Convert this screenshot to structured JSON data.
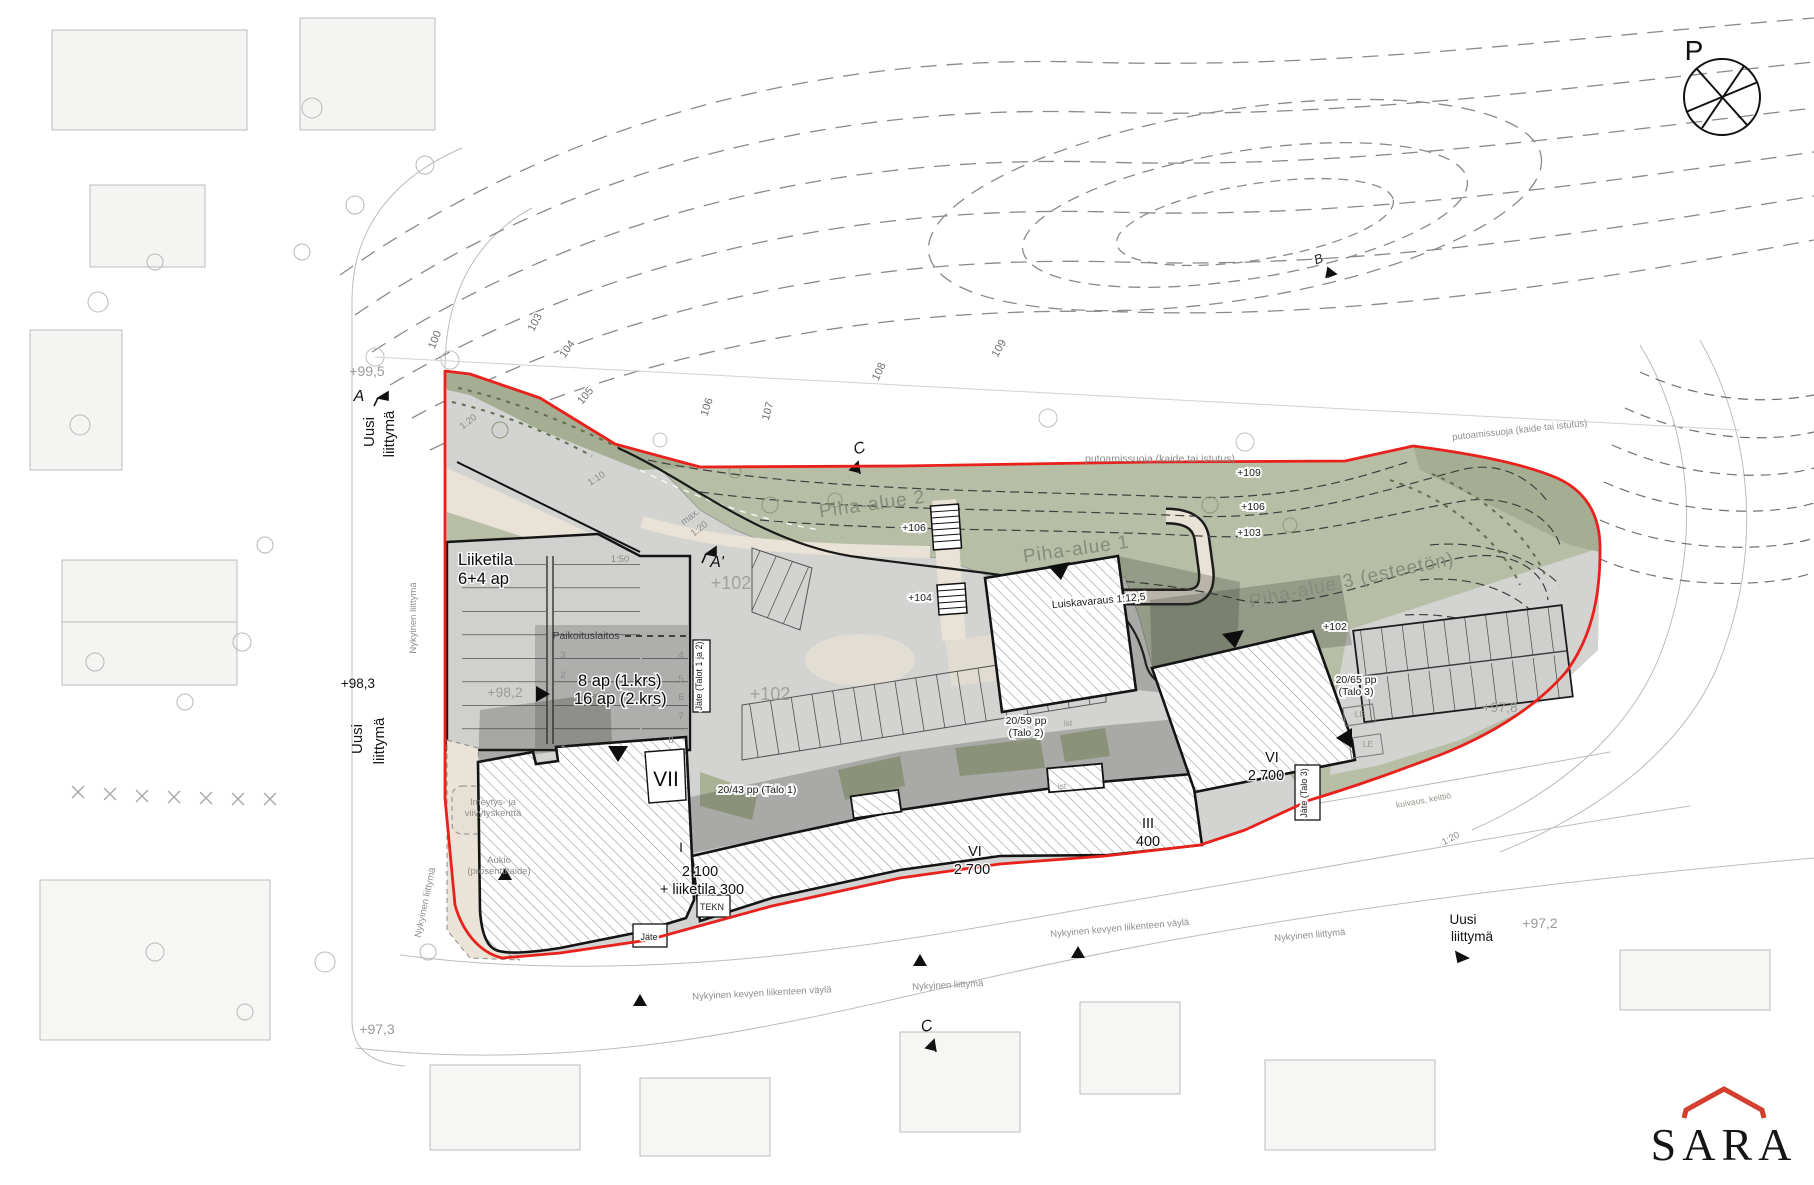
{
  "compass": {
    "letter": "P"
  },
  "logo": {
    "text": "SARA"
  },
  "colors": {
    "site_boundary_red": "#e8211c",
    "green_yard": "#b6bea6",
    "green_slope_dark": "#a5ae93",
    "paving_gray": "#d3d3d1",
    "deck_shadow": "rgba(40,42,38,0.20)",
    "building_fill": "#ffffff",
    "building_outline": "#141414",
    "path_beige": "#e9e2d6",
    "logo_red": "#d4402f"
  },
  "labels": [
    {
      "id": "contour-label-100",
      "text": "100",
      "x": 438,
      "y": 341,
      "rot": -68,
      "cls": "contour"
    },
    {
      "id": "contour-label-103",
      "text": "103",
      "x": 538,
      "y": 324,
      "rot": -62,
      "cls": "contour"
    },
    {
      "id": "contour-label-104",
      "text": "104",
      "x": 570,
      "y": 351,
      "rot": -55,
      "cls": "contour"
    },
    {
      "id": "contour-label-105",
      "text": "105",
      "x": 588,
      "y": 398,
      "rot": -50,
      "cls": "contour"
    },
    {
      "id": "contour-label-106",
      "text": "106",
      "x": 710,
      "y": 408,
      "rot": -72,
      "cls": "contour"
    },
    {
      "id": "contour-label-107",
      "text": "107",
      "x": 771,
      "y": 412,
      "rot": -75,
      "cls": "contour"
    },
    {
      "id": "contour-label-108",
      "text": "108",
      "x": 882,
      "y": 373,
      "rot": -65,
      "cls": "contour"
    },
    {
      "id": "contour-label-109",
      "text": "109",
      "x": 1002,
      "y": 350,
      "rot": -60,
      "cls": "contour"
    },
    {
      "id": "elevation-99-5",
      "text": "+99,5",
      "x": 367,
      "y": 376,
      "cls": "gray-med"
    },
    {
      "id": "section-marker-a",
      "text": "A",
      "x": 359,
      "y": 401,
      "cls": "section"
    },
    {
      "id": "new-junction-1-line1",
      "text": "Uusi",
      "x": 374,
      "y": 432,
      "rot": -90,
      "cls": "v15"
    },
    {
      "id": "new-junction-1-line2",
      "text": "liittymä",
      "x": 394,
      "y": 434,
      "rot": -90,
      "cls": "v15"
    },
    {
      "id": "slope-1-20-top",
      "text": "1:20",
      "x": 470,
      "y": 424,
      "rot": -38,
      "cls": "gray-small"
    },
    {
      "id": "slope-1-10",
      "text": "1:10",
      "x": 598,
      "y": 481,
      "rot": -33,
      "cls": "gray-small"
    },
    {
      "id": "liiketila-line1",
      "text": "Liiketila",
      "x": 458,
      "y": 565,
      "cls": "black-16"
    },
    {
      "id": "liiketila-line2",
      "text": "6+4 ap",
      "x": 458,
      "y": 584,
      "cls": "black-16"
    },
    {
      "id": "slope-1-50",
      "text": "1:50",
      "x": 620,
      "y": 562,
      "cls": "gray-small"
    },
    {
      "id": "slope-max-line1",
      "text": "max.",
      "x": 692,
      "y": 519,
      "rot": -38,
      "cls": "gray-small"
    },
    {
      "id": "slope-max-line2",
      "text": "1:20",
      "x": 701,
      "y": 531,
      "rot": -38,
      "cls": "gray-small"
    },
    {
      "id": "section-marker-a2",
      "text": "A'",
      "x": 717,
      "y": 567,
      "cls": "section"
    },
    {
      "id": "elevation-102-a",
      "text": "+102",
      "x": 731,
      "y": 589,
      "cls": "gray-big"
    },
    {
      "id": "paikoituslaitos",
      "text": "Paikoituslaitos",
      "x": 586,
      "y": 639,
      "cls": "dark-10"
    },
    {
      "id": "parking-8ap",
      "text": "8 ap (1.krs)",
      "x": 578,
      "y": 686,
      "cls": "black-16"
    },
    {
      "id": "parking-16ap",
      "text": "16 ap (2.krs)",
      "x": 574,
      "y": 704,
      "cls": "black-16"
    },
    {
      "id": "elevation-98-2",
      "text": "+98,2",
      "x": 505,
      "y": 697,
      "cls": "gray-med"
    },
    {
      "id": "stall-number-3",
      "text": "3",
      "x": 563,
      "y": 658,
      "cls": "gray-small"
    },
    {
      "id": "stall-number-2",
      "text": "2",
      "x": 563,
      "y": 678,
      "cls": "gray-small"
    },
    {
      "id": "stall-number-4",
      "text": "4",
      "x": 681,
      "y": 658,
      "cls": "gray-small"
    },
    {
      "id": "stall-number-5",
      "text": "5",
      "x": 681,
      "y": 682,
      "cls": "gray-small"
    },
    {
      "id": "stall-number-6",
      "text": "6",
      "x": 681,
      "y": 700,
      "cls": "gray-small"
    },
    {
      "id": "stall-number-7",
      "text": "7",
      "x": 681,
      "y": 719,
      "cls": "gray-small"
    },
    {
      "id": "stall-number-1",
      "text": "1",
      "x": 563,
      "y": 747,
      "cls": "gray-small"
    },
    {
      "id": "stall-number-8",
      "text": "8",
      "x": 671,
      "y": 743,
      "cls": "gray-small"
    },
    {
      "id": "waste-talo-1-2",
      "text": "Jäte (Talot 1 ja 2)",
      "x": 702,
      "y": 676,
      "rot": -90,
      "cls": "boxed-8"
    },
    {
      "id": "building-vii",
      "text": "VII",
      "x": 666,
      "y": 786,
      "cls": "black-20"
    },
    {
      "id": "building-i",
      "text": "I",
      "x": 681,
      "y": 852,
      "cls": "black-14"
    },
    {
      "id": "area-2100",
      "text": "2 100",
      "x": 700,
      "y": 876,
      "cls": "black-15"
    },
    {
      "id": "area-liiketila-300",
      "text": "+ liiketila 300",
      "x": 702,
      "y": 894,
      "cls": "black-15"
    },
    {
      "id": "tekn-room",
      "text": "TEKN",
      "x": 712,
      "y": 910,
      "cls": "boxed-8"
    },
    {
      "id": "waste-1",
      "text": "Jäte",
      "x": 649,
      "y": 940,
      "cls": "boxed-8"
    },
    {
      "id": "bikes-talo-1",
      "text": "20/43 pp (Talo 1)",
      "x": 757,
      "y": 793,
      "cls": "boxed-10"
    },
    {
      "id": "bikes-talo-2-line1",
      "text": "20/59 pp",
      "x": 1026,
      "y": 724,
      "cls": "boxed-10"
    },
    {
      "id": "bikes-talo-2-line2",
      "text": "(Talo 2)",
      "x": 1026,
      "y": 736,
      "cls": "boxed-10"
    },
    {
      "id": "building-vi-mid",
      "text": "VI",
      "x": 975,
      "y": 856,
      "cls": "black-15"
    },
    {
      "id": "area-vi-mid",
      "text": "2 700",
      "x": 972,
      "y": 874,
      "cls": "black-15"
    },
    {
      "id": "building-iii",
      "text": "III",
      "x": 1148,
      "y": 828,
      "cls": "black-15"
    },
    {
      "id": "area-iii",
      "text": "400",
      "x": 1148,
      "y": 846,
      "cls": "black-15"
    },
    {
      "id": "planting-ist-1",
      "text": "ist",
      "x": 1068,
      "y": 726,
      "cls": "gray-tiny"
    },
    {
      "id": "planting-ist-2",
      "text": "ist",
      "x": 1062,
      "y": 789,
      "cls": "gray-tiny"
    },
    {
      "id": "yard-area-2",
      "text": "Piha-alue 2",
      "x": 873,
      "y": 510,
      "rot": -8,
      "cls": "piha"
    },
    {
      "id": "yard-area-1",
      "text": "Piha-alue 1",
      "x": 1077,
      "y": 555,
      "rot": -8,
      "cls": "piha"
    },
    {
      "id": "yard-area-3",
      "text": "Piha-alue 3 (esteetön)",
      "x": 1353,
      "y": 586,
      "rot": -12,
      "cls": "piha"
    },
    {
      "id": "elevation-106-mid",
      "text": "+106",
      "x": 914,
      "y": 531,
      "cls": "boxed-10"
    },
    {
      "id": "elevation-104-mid",
      "text": "+104",
      "x": 920,
      "y": 601,
      "cls": "boxed-10"
    },
    {
      "id": "ramp-reservation",
      "text": "Luiskavaraus 1:12,5",
      "x": 1099,
      "y": 604,
      "rot": -5,
      "cls": "boxed-10"
    },
    {
      "id": "fall-protection-1",
      "text": "putoamissuoja (kaide tai istutus)",
      "x": 1160,
      "y": 462,
      "cls": "gray-10"
    },
    {
      "id": "fall-protection-2",
      "text": "putoamissuoja (kaide tai istutus)",
      "x": 1520,
      "y": 433,
      "rot": -6,
      "cls": "gray-9"
    },
    {
      "id": "elevation-109",
      "text": "+109",
      "x": 1249,
      "y": 476,
      "cls": "boxed-10"
    },
    {
      "id": "elevation-106-r",
      "text": "+106",
      "x": 1253,
      "y": 510,
      "cls": "boxed-10"
    },
    {
      "id": "elevation-103-r",
      "text": "+103",
      "x": 1249,
      "y": 536,
      "cls": "boxed-10"
    },
    {
      "id": "elevation-102-r",
      "text": "+102",
      "x": 1335,
      "y": 630,
      "cls": "boxed-10"
    },
    {
      "id": "elevation-102-b",
      "text": "+102",
      "x": 770,
      "y": 700,
      "cls": "gray-big"
    },
    {
      "id": "building-vi-right",
      "text": "VI",
      "x": 1272,
      "y": 762,
      "cls": "black-15"
    },
    {
      "id": "area-vi-right",
      "text": "2 700",
      "x": 1266,
      "y": 780,
      "cls": "black-15"
    },
    {
      "id": "bikes-talo-3-line1",
      "text": "20/65 pp",
      "x": 1356,
      "y": 683,
      "cls": "boxed-10"
    },
    {
      "id": "bikes-talo-3-line2",
      "text": "(Talo 3)",
      "x": 1356,
      "y": 695,
      "cls": "boxed-10"
    },
    {
      "id": "waste-talo-3",
      "text": "Jäte (Talo 3)",
      "x": 1307,
      "y": 793,
      "rot": -90,
      "cls": "boxed-8"
    },
    {
      "id": "play-le-1",
      "text": "LE",
      "x": 1360,
      "y": 717,
      "cls": "gray-tiny"
    },
    {
      "id": "play-le-2",
      "text": "LE",
      "x": 1368,
      "y": 747,
      "cls": "gray-tiny"
    },
    {
      "id": "elevation-97-8",
      "text": "+97,8",
      "x": 1500,
      "y": 712,
      "cls": "gray-med"
    },
    {
      "id": "drying-kitchen",
      "text": "kuivaus, keittiö",
      "x": 1424,
      "y": 803,
      "rot": -10,
      "cls": "gray-tiny"
    },
    {
      "id": "slope-1-20-right",
      "text": "1:20",
      "x": 1452,
      "y": 841,
      "rot": -28,
      "cls": "gray-small"
    },
    {
      "id": "elevation-98-3",
      "text": "+98,3",
      "x": 358,
      "y": 688,
      "cls": "black-14"
    },
    {
      "id": "new-junction-2-line1",
      "text": "Uusi",
      "x": 362,
      "y": 739,
      "rot": -90,
      "cls": "v15"
    },
    {
      "id": "new-junction-2-line2",
      "text": "liittymä",
      "x": 384,
      "y": 741,
      "rot": -90,
      "cls": "v15"
    },
    {
      "id": "existing-junction-1",
      "text": "Nykyinen liittymä",
      "x": 416,
      "y": 618,
      "rot": -90,
      "cls": "gray-9"
    },
    {
      "id": "existing-junction-2",
      "text": "Nykyinen liittymä",
      "x": 428,
      "y": 903,
      "rot": -78,
      "cls": "gray-9"
    },
    {
      "id": "elevation-97-3",
      "text": "+97,3",
      "x": 377,
      "y": 1034,
      "cls": "gray-med"
    },
    {
      "id": "existing-pedestrian-way-1",
      "text": "Nykyinen kevyen liikenteen väylä",
      "x": 762,
      "y": 996,
      "rot": -3,
      "cls": "gray-9"
    },
    {
      "id": "existing-junction-3",
      "text": "Nykyinen liittymä",
      "x": 948,
      "y": 988,
      "rot": -3,
      "cls": "gray-9"
    },
    {
      "id": "existing-pedestrian-way-2",
      "text": "Nykyinen kevyen liikenteen väylä",
      "x": 1120,
      "y": 931,
      "rot": -5,
      "cls": "gray-9"
    },
    {
      "id": "existing-junction-4",
      "text": "Nykyinen liittymä",
      "x": 1310,
      "y": 938,
      "rot": -5,
      "cls": "gray-9"
    },
    {
      "id": "new-junction-3-line1",
      "text": "Uusi",
      "x": 1463,
      "y": 924,
      "cls": "black-14"
    },
    {
      "id": "new-junction-3-line2",
      "text": "liittymä",
      "x": 1472,
      "y": 941,
      "cls": "black-14"
    },
    {
      "id": "elevation-97-2",
      "text": "+97,2",
      "x": 1540,
      "y": 928,
      "cls": "gray-med"
    },
    {
      "id": "section-marker-c-top",
      "text": "C",
      "x": 861,
      "y": 453,
      "rot": -20,
      "cls": "section"
    },
    {
      "id": "section-marker-c-bottom",
      "text": "C",
      "x": 928,
      "y": 1031,
      "rot": -15,
      "cls": "section"
    },
    {
      "id": "section-marker-b",
      "text": "B",
      "x": 1320,
      "y": 263,
      "rot": -20,
      "cls": "section-sm"
    },
    {
      "id": "infiltration-field-line1",
      "text": "Imeytys- ja",
      "x": 493,
      "y": 805,
      "cls": "gray-9"
    },
    {
      "id": "infiltration-field-line2",
      "text": "viivytyskenttä",
      "x": 493,
      "y": 816,
      "cls": "gray-9"
    },
    {
      "id": "plaza-line1",
      "text": "Aukio",
      "x": 499,
      "y": 863,
      "cls": "gray-9"
    },
    {
      "id": "plaza-line2",
      "text": "(prosenttitaide)",
      "x": 499,
      "y": 874,
      "cls": "gray-9"
    }
  ]
}
